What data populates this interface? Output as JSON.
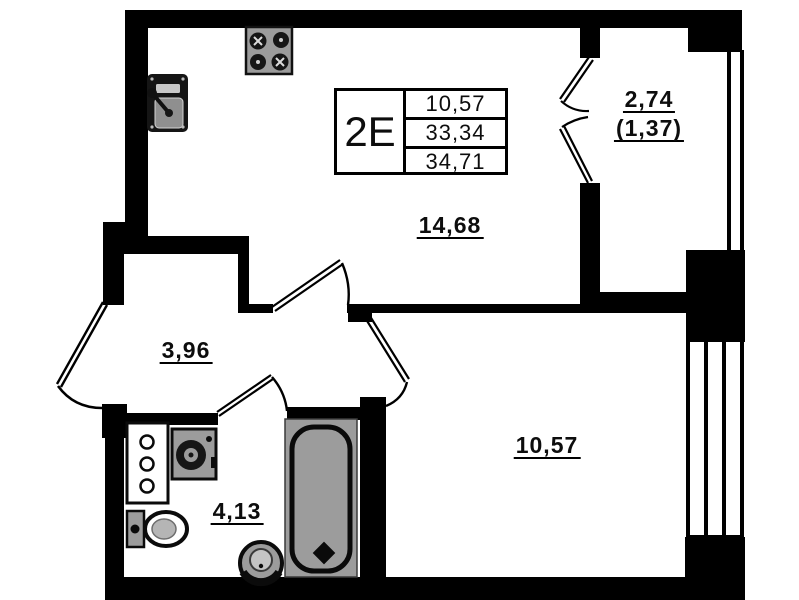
{
  "unit": {
    "label": "2Е",
    "values": [
      "10,57",
      "33,34",
      "34,71"
    ]
  },
  "rooms": {
    "kitchen_living": {
      "area": "14,68"
    },
    "balcony": {
      "area": "2,74",
      "area_coefficient": "(1,37)"
    },
    "hallway": {
      "area": "3,96"
    },
    "bathroom": {
      "area": "4,13"
    },
    "bedroom": {
      "area": "10,57"
    }
  },
  "fixtures": {
    "stove": "stove-4-burner-icon",
    "kitchen_sink": "kitchen-sink-icon",
    "cabinet": "shelf-cabinet-icon",
    "washing_machine": "washing-machine-icon",
    "toilet": "toilet-icon",
    "pedestal_sink": "pedestal-sink-icon",
    "bathtub": "bathtub-icon"
  },
  "colors": {
    "wall": "#000000",
    "background": "#ffffff",
    "fixture_gray": "#9c9c9c",
    "fixture_dark": "#161616",
    "text": "#0d0d0d"
  }
}
